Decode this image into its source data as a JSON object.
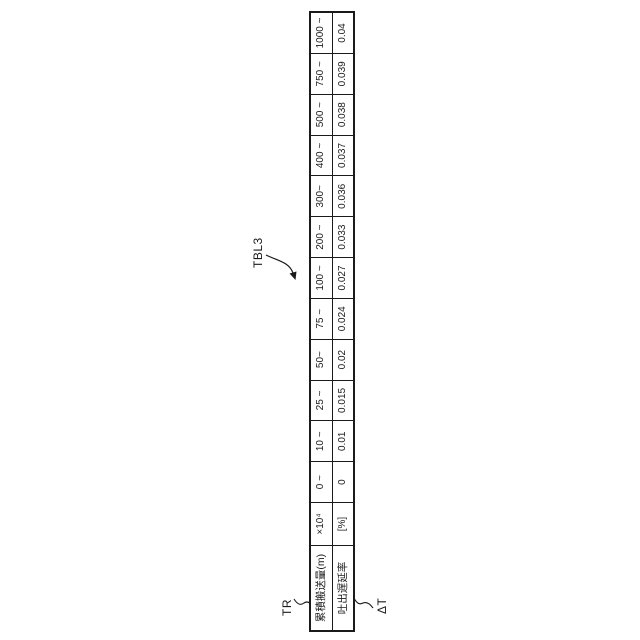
{
  "figure": {
    "colors": {
      "background": "#ffffff",
      "line": "#1a1a1a",
      "text": "#1a1a1a"
    },
    "refs": {
      "table_label": "TBL3",
      "row1_label": "TR",
      "row2_label": "ΔT"
    },
    "table": {
      "row1_header": "累積搬送量(m)",
      "row1_unit": "×10⁴",
      "row2_header": "吐出遅延率",
      "row2_unit": "[%]",
      "columns": [
        {
          "range": "0 ~",
          "value": "0"
        },
        {
          "range": "10 ~",
          "value": "0.01"
        },
        {
          "range": "25 ~",
          "value": "0.015"
        },
        {
          "range": "50~",
          "value": "0.02"
        },
        {
          "range": "75 ~",
          "value": "0.024"
        },
        {
          "range": "100 ~",
          "value": "0.027"
        },
        {
          "range": "200 ~",
          "value": "0.033"
        },
        {
          "range": "300~",
          "value": "0.036"
        },
        {
          "range": "400 ~",
          "value": "0.037"
        },
        {
          "range": "500 ~",
          "value": "0.038"
        },
        {
          "range": "750 ~",
          "value": "0.039"
        },
        {
          "range": "1000 ~",
          "value": "0.04"
        }
      ]
    }
  }
}
